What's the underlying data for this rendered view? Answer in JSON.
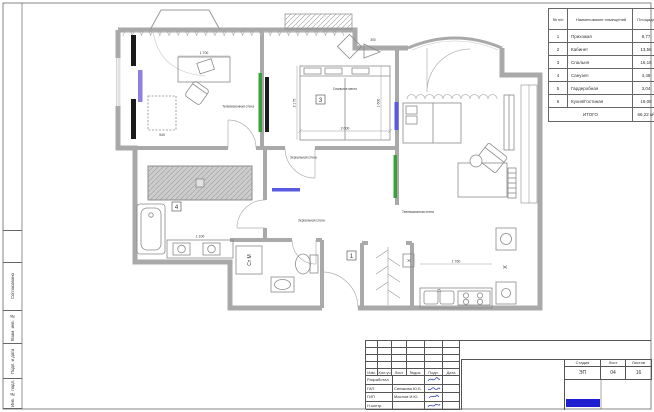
{
  "schedule": {
    "col_num": "№ п/п",
    "col_name": "Наименование помещений",
    "col_area": "Площадь",
    "rows": [
      {
        "num": "1",
        "name": "Прихожая",
        "area": "8,77"
      },
      {
        "num": "2",
        "name": "Кабинет",
        "area": "13,58"
      },
      {
        "num": "3",
        "name": "Спальня",
        "area": "16,16"
      },
      {
        "num": "4",
        "name": "Санузел",
        "area": "4,48"
      },
      {
        "num": "5",
        "name": "Гардеробная",
        "area": "3,04"
      },
      {
        "num": "6",
        "name": "Кухня/Гостиная",
        "area": "19,08"
      }
    ],
    "total_label": "ИТОГО",
    "total_value": "66,22 м²"
  },
  "stamps": {
    "s1": "Согласовано",
    "s2": "Взам. инв. №",
    "s3": "Подп. и дата",
    "s4": "Инв. № подл."
  },
  "titleblock": {
    "rev_header": [
      "Изм.",
      "Кол.уч",
      "Лист",
      "№док.",
      "Подп.",
      "Дата"
    ],
    "roles": [
      {
        "role": "Разработал",
        "name": ""
      },
      {
        "role": "ГАП",
        "name": "Синякова Ю.Б."
      },
      {
        "role": "ГИП",
        "name": "Маслов И.Ю."
      },
      {
        "role": "Н.контр.",
        "name": ""
      }
    ],
    "stage_header": [
      "Стадия",
      "Лист",
      "Листов"
    ],
    "stage": "ЭП",
    "sheet_no": "04",
    "sheets_total": "16"
  },
  "plan": {
    "rooms": {
      "r1": "1",
      "r3": "3",
      "r4": "4"
    },
    "labels": {
      "tv_wall": "Телевизионная стена",
      "mirror_wall": "Зеркальная стена",
      "bed": "Спальное место",
      "washer": "Ст М",
      "fridge": "Х"
    },
    "dims": {
      "desk": "1 700",
      "bed_w": "2 000",
      "bed_h": "1 600",
      "room_h": "2 175",
      "d300": "300",
      "rack": "940",
      "vanity": "1 100",
      "kitchen": "1 760"
    },
    "colors": {
      "green": "#3aa03a",
      "blue": "#5a5ae0",
      "purple": "#8f7fe0",
      "logo": "#1f1fd0"
    }
  }
}
